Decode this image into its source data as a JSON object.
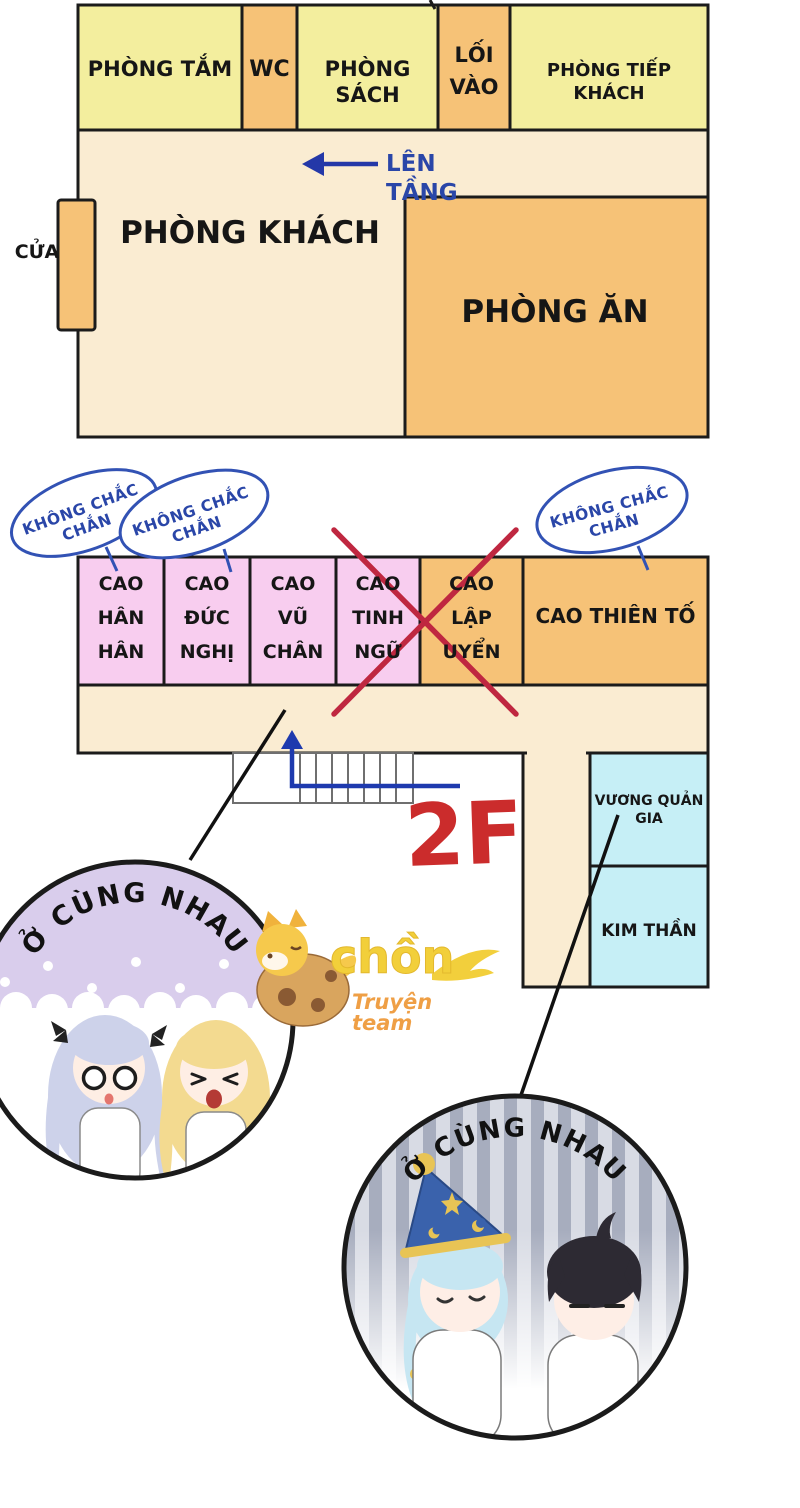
{
  "floor1": {
    "rooms": {
      "bathroom": "PHÒNG TẮM",
      "wc": "WC",
      "book_room": "PHÒNG SÁCH",
      "entrance": "LỐI VÀO",
      "guest_room": "PHÒNG TIẾP KHÁCH",
      "living_room": "PHÒNG KHÁCH",
      "dining_room": "PHÒNG ĂN"
    },
    "door_label": "CỬA",
    "upstairs_note": "LÊN TẦNG"
  },
  "floor2": {
    "floor_label": "2F",
    "rooms": {
      "room1": "CAO\nHÂN\nHÂN",
      "room2": "CAO\nĐỨC\nNGHỊ",
      "room3": "CAO\nVŨ\nCHÂN",
      "room4": "CAO\nTINH\nNGỮ",
      "room5_crossed": "CAO\nLẬP\nUYỂN",
      "room6": "CAO THIÊN TỐ",
      "room7": "VƯƠNG QUẢN GIA",
      "room8": "KIM THẦN"
    },
    "uncertain_bubbles": [
      "KHÔNG CHẮC CHẮN",
      "KHÔNG CHẮC CHẮN",
      "KHÔNG CHẮC CHẮN"
    ]
  },
  "callouts": {
    "left_circle_caption": "Ở CÙNG NHAU",
    "right_circle_caption": "Ở CÙNG NHAU"
  },
  "watermark": {
    "name": "chồn",
    "subtitle": "Truyện team"
  },
  "colors": {
    "room_yellow": "#f3ee9e",
    "room_orange": "#f6c277",
    "room_pink": "#f8cdef",
    "room_cyan": "#c6eff6",
    "floor_cream": "#faecd2",
    "wall_black": "#1b1b1b",
    "annotation_blue": "#2a46a8",
    "cross_red": "#bf2740",
    "floor_label_red": "#cb2c2c",
    "circle_purple": "#d9cdec"
  }
}
